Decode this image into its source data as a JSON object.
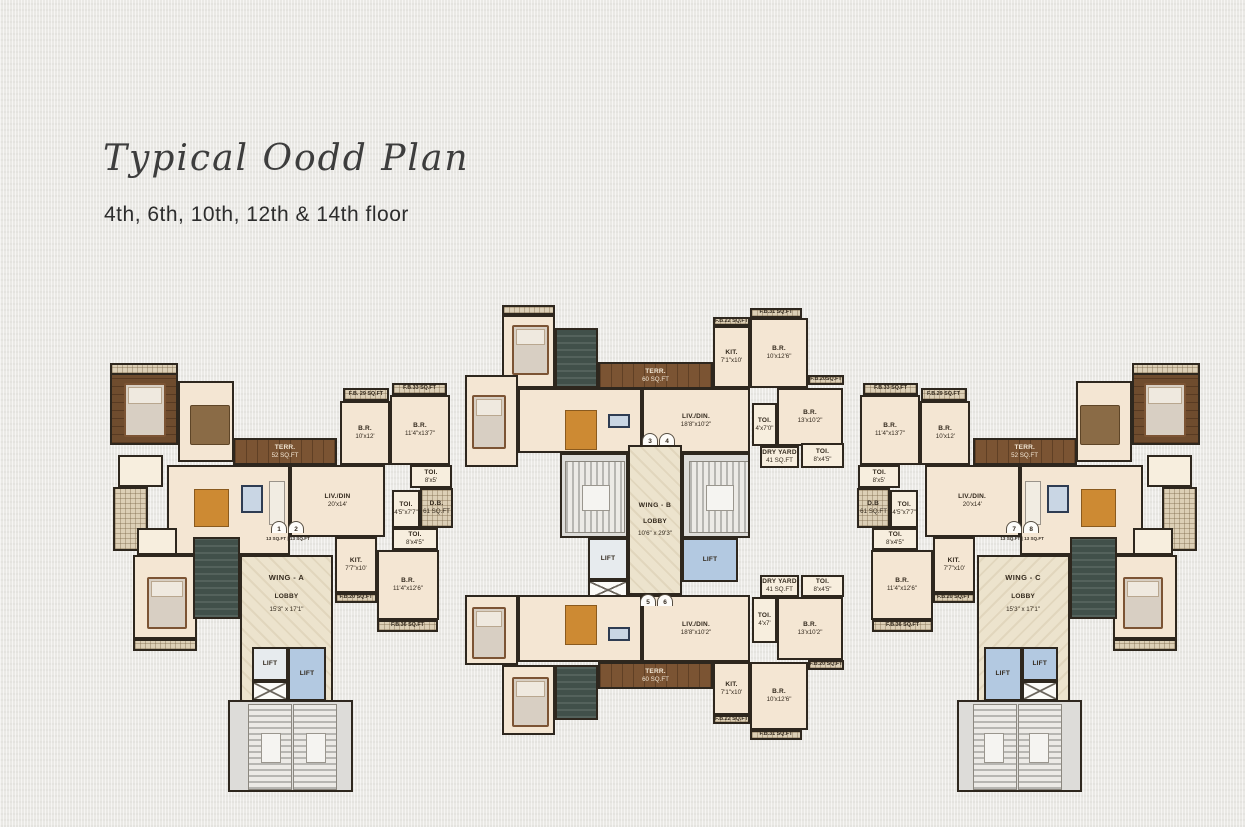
{
  "page": {
    "title": "Typical Oodd Plan",
    "subtitle": "4th, 6th, 10th, 12th & 14th floor"
  },
  "wing_a": {
    "name": "WING - A",
    "lobby": {
      "l1": "LOBBY",
      "l2": "15'3\" x 17'1\""
    },
    "doors": {
      "n1": "1",
      "n2": "2",
      "area": "13 SQ.FT | 13 SQ.FT"
    },
    "terr": {
      "n": "TERR.",
      "d": "52 SQ.FT"
    },
    "livdin": {
      "n": "LIV./DIN",
      "d": "20'x14'"
    },
    "fb29": "F.B. 29 SQ.FT",
    "fb33": "F.B.33 SQ.FT",
    "br_10x12": {
      "n": "B.R.",
      "d": "10'x12'"
    },
    "br_114x137": {
      "n": "B.R.",
      "d": "11'4\"x13'7\""
    },
    "toi_8x5": {
      "n": "TOI.",
      "d": "8'x5'"
    },
    "db": {
      "n": "D.B.",
      "d": "61 SQ.FT"
    },
    "toi_45x77": {
      "n": "TOI.",
      "d": "4'5\"x7'7\""
    },
    "toi_8x45": {
      "n": "TOI.",
      "d": "8'x4'5\""
    },
    "kit": {
      "n": "KIT.",
      "d": "7'7\"x10'"
    },
    "br_114x126": {
      "n": "B.R.",
      "d": "11'4\"x12'6\""
    },
    "fb20": "F.B.20 SQ.FT",
    "fb36": "F.B.36 SQ.FT",
    "lift": "LIFT"
  },
  "wing_b": {
    "name": "WING - B",
    "lobby": {
      "l1": "LOBBY",
      "l2": "10'6\" x 29'3\""
    },
    "doors_top": {
      "n1": "3",
      "n2": "4"
    },
    "doors_bottom": {
      "n1": "5",
      "n2": "6"
    },
    "lift": "LIFT",
    "top": {
      "fb22": "F.B.22 SQ.FT",
      "fb31": "F.B.31 SQ.FT",
      "fb20": "F.B.20SQ.FT",
      "kit": {
        "n": "KIT.",
        "d": "7'1\"x10'"
      },
      "br1": {
        "n": "B.R.",
        "d": "10'x12'6\""
      },
      "terr": {
        "n": "TERR.",
        "d": "60 SQ.FT"
      },
      "livdin": {
        "n": "LIV./DIN.",
        "d": "18'8\"x10'2\""
      },
      "toi1": {
        "n": "TOI.",
        "d": "4'x7'0\""
      },
      "br2": {
        "n": "B.R.",
        "d": "13'x10'2\""
      },
      "dry": {
        "n": "DRY YARD",
        "d": "41 SQ.FT"
      },
      "toi2": {
        "n": "TOI.",
        "d": "8'x4'5\""
      }
    },
    "bottom": {
      "fb22": "F.B.22 SQ.FT",
      "fb31": "F.B.31 SQ.FT",
      "fb20": "F.B.20 SQ.FT",
      "kit": {
        "n": "KIT.",
        "d": "7'1\"x10'"
      },
      "br1": {
        "n": "B.R.",
        "d": "10'x12'6\""
      },
      "terr": {
        "n": "TERR.",
        "d": "60 SQ.FT"
      },
      "livdin": {
        "n": "LIV./DIN.",
        "d": "18'8\"x10'2\""
      },
      "toi1": {
        "n": "TOI.",
        "d": "4'x7'"
      },
      "br2": {
        "n": "B.R.",
        "d": "13'x10'2\""
      },
      "dry": {
        "n": "DRY YARD",
        "d": "41 SQ.FT"
      },
      "toi2": {
        "n": "TOI.",
        "d": "8'x4'5\""
      }
    }
  },
  "wing_c": {
    "name": "WING - C",
    "lobby": {
      "l1": "LOBBY",
      "l2": "15'3\" x 17'1\""
    },
    "doors": {
      "n1": "7",
      "n2": "8",
      "area": "13 SQ.FT | 13 SQ.FT"
    },
    "terr": {
      "n": "TERR.",
      "d": "52 SQ.FT"
    },
    "livdin": {
      "n": "LIV./DIN.",
      "d": "20'x14'"
    },
    "fb29": "F.B.29 SQ.FT",
    "fb33": "F.B.33 SQ.FT",
    "br_10x12": {
      "n": "B.R.",
      "d": "10'x12'"
    },
    "br_114x137": {
      "n": "B.R.",
      "d": "11'4\"x13'7\""
    },
    "toi_8x5": {
      "n": "TOI.",
      "d": "8'x5'"
    },
    "db": {
      "n": "D.B",
      "d": "61 SQ.FT"
    },
    "toi_45x77": {
      "n": "TOI.",
      "d": "4'5\"x7'7\""
    },
    "toi_8x45": {
      "n": "TOI.",
      "d": "8'x4'5\""
    },
    "kit": {
      "n": "KIT.",
      "d": "7'7\"x10'"
    },
    "br_114x126": {
      "n": "B.R.",
      "d": "11'4\"x12'6\""
    },
    "fb20": "F.B.20 SQ.FT",
    "fb36": "F.B.36 SQ.FT",
    "lift": "LIFT"
  }
}
